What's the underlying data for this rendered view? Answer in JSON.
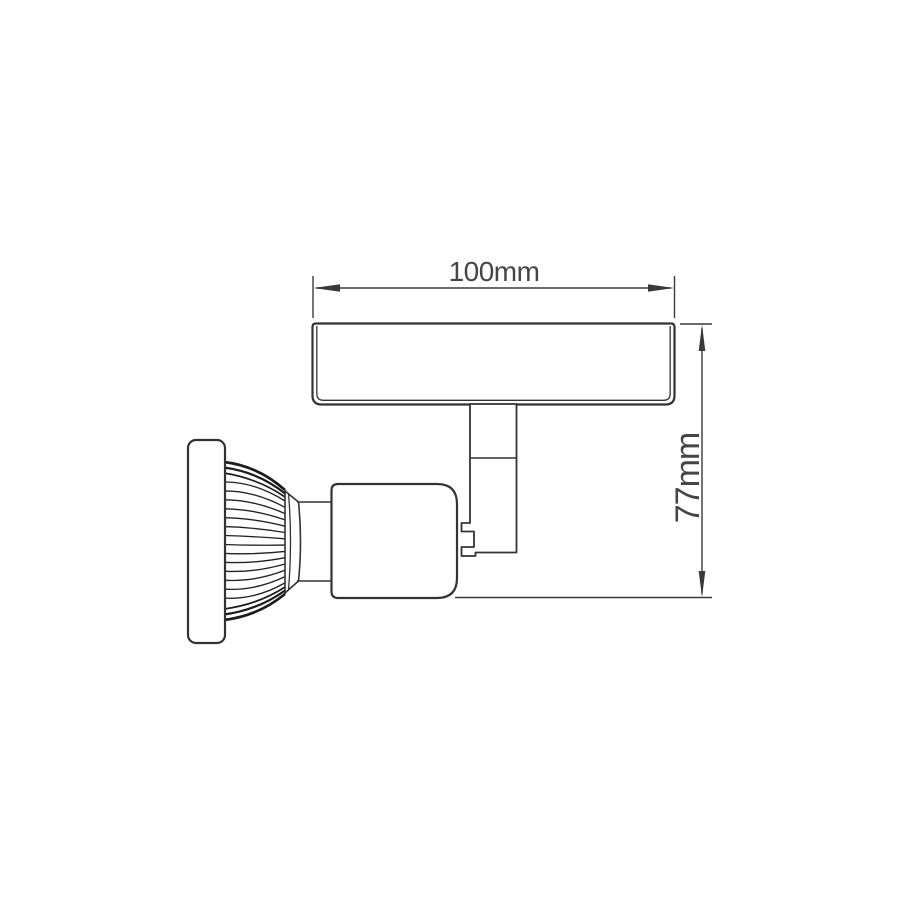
{
  "diagram": {
    "type": "technical-drawing",
    "subject": "spotlight-fixture-side-view",
    "parts": [
      "canopy-plate",
      "mounting-stem",
      "swivel-clamp",
      "lamp-holder-body",
      "lamp-neck",
      "heatsink-fins",
      "front-bezel"
    ],
    "dimensions": {
      "width": {
        "label": "100mm",
        "value": 100,
        "unit": "mm"
      },
      "height": {
        "label": "77mm",
        "value": 77,
        "unit": "mm"
      }
    },
    "colors": {
      "background": "#ffffff",
      "line": "#3a3a3a",
      "part_line": "#333333",
      "fin_dark": "#1c1c1c",
      "text": "#454545"
    }
  }
}
